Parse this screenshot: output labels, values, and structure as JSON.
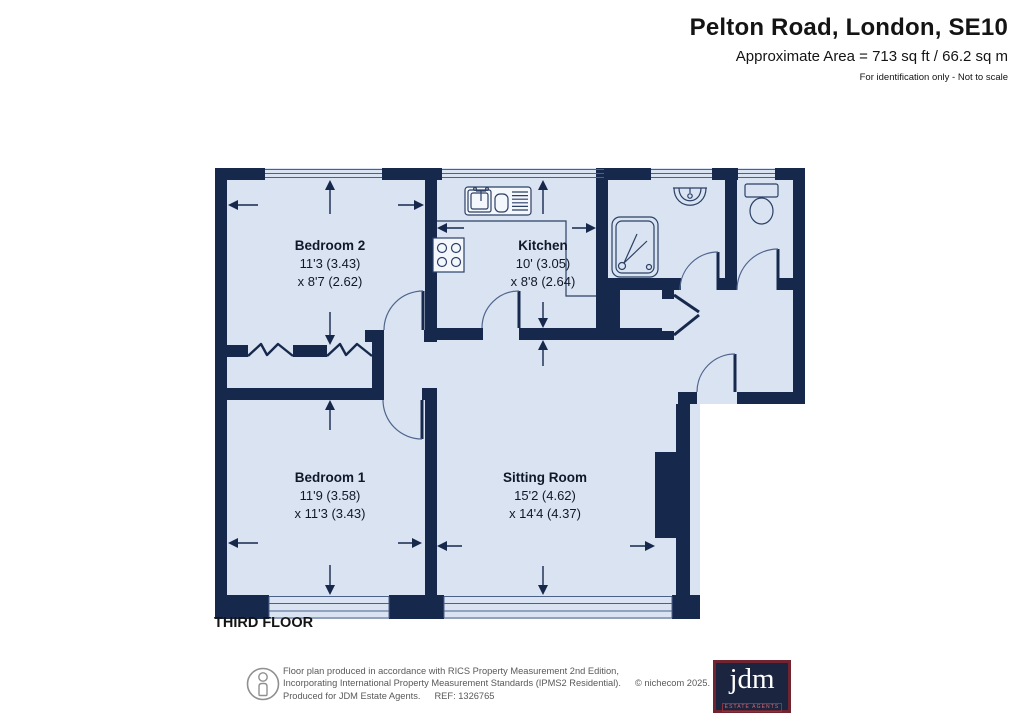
{
  "header": {
    "title": "Pelton Road, London, SE10",
    "area_line": "Approximate Area = 713 sq ft / 66.2 sq m",
    "note": "For identification only - Not to scale"
  },
  "floor_label": "THIRD FLOOR",
  "rooms": [
    {
      "name": "Bedroom 2",
      "dim_line1": "11'3 (3.43)",
      "dim_line2": "x 8'7 (2.62)"
    },
    {
      "name": "Kitchen",
      "dim_line1": "10' (3.05)",
      "dim_line2": "x 8'8 (2.64)"
    },
    {
      "name": "Bedroom 1",
      "dim_line1": "11'9 (3.58)",
      "dim_line2": "x 11'3 (3.43)"
    },
    {
      "name": "Sitting Room",
      "dim_line1": "15'2 (4.62)",
      "dim_line2": "x 14'4 (4.37)"
    }
  ],
  "footer": {
    "line1": "Floor plan produced in accordance with RICS Property Measurement 2nd Edition,",
    "line2": "Incorporating International Property Measurement Standards (IPMS2 Residential).",
    "copyright": "© nichecom 2025.",
    "line3": "Produced for JDM Estate Agents.",
    "ref": "REF: 1326765"
  },
  "logo": {
    "text": "jdm",
    "tagline": "ESTATE AGENTS"
  },
  "colors": {
    "wall": "#16294d",
    "floor": "#d9e3f1",
    "glaze": "#4b608a",
    "logo_border": "#6f2430",
    "logo_bg": "#1b2540"
  }
}
